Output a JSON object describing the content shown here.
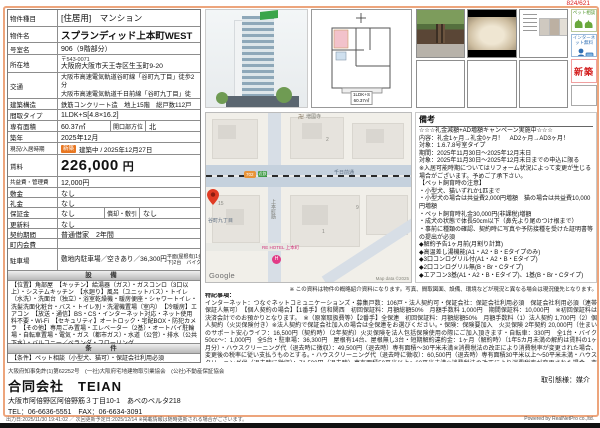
{
  "header": {
    "ref": "824/621"
  },
  "table": {
    "r_type": {
      "label": "物件種目",
      "value": "[住居用]　マンション"
    },
    "r_name": {
      "label": "物件名",
      "value": "スプランディッド上本町WEST"
    },
    "r_room": {
      "label": "号室名",
      "value": "906（9階部分）"
    },
    "r_addr": {
      "label": "所在地",
      "postal": "〒543-0071",
      "value": "大阪府大阪市天王寺区生玉町9-20"
    },
    "r_access": {
      "label": "交通",
      "lines": "大阪市高速電気軌道谷町線「谷町九丁目」徒歩2分\n大阪市高速電気軌道千日前線「谷町九丁目」徒歩2分\n近鉄難波・奈良線「大阪上本町」徒歩8分"
    },
    "r_structure": {
      "label": "建築構造",
      "value": "鉄筋コンクリート造　地上15階　総戸数112戸"
    },
    "r_layout": {
      "label": "間取タイプ",
      "value": "1LDK+S[4.8×16.2]"
    },
    "r_area": {
      "label": "専有面積",
      "value": "60.37㎡",
      "label2": "開口部方位",
      "value2": "北"
    },
    "r_built": {
      "label": "築年",
      "value": "2025年12月"
    },
    "r_status": {
      "label": "現況/入居時期",
      "badge": "新築",
      "value": "建築中 / 2025年12月27日"
    },
    "r_rent": {
      "label": "賃料",
      "value": "226,000",
      "unit": "円"
    },
    "r_fee": {
      "label": "共益費・管理費",
      "value": "12,000円"
    },
    "r_shikikin": {
      "label": "敷金",
      "value": "なし"
    },
    "r_reikin": {
      "label": "礼金",
      "value": "なし"
    },
    "r_hoshokin": {
      "label": "保証金",
      "value": "なし",
      "label2": "償却・敷引",
      "value2": "なし"
    },
    "r_koshin": {
      "label": "更新料",
      "value": "なし"
    },
    "r_keiyaku": {
      "label": "契約期間",
      "value": "普通借家　2年間"
    },
    "r_chonai": {
      "label": "町内会費",
      "value": ""
    },
    "r_parking": {
      "label": "駐車場",
      "value": "敷地内駐車場／空きあり／36,300円",
      "detail": "平面(屋根有)1台 平面(屋根無)2台 機械式(地上)1台 機械式(地下)2台　バイク(屋根有)9台 ミニバイク(屋根有)9台"
    }
  },
  "facilities": {
    "header": "設　備",
    "text": "【位置】角部屋　【キッチン】給湯器（ガス）・ガスコンロ（3口以上）・システムキッチン　【水廻り】風呂（ユニットバス）・トイレ（水洗）・洗面台（独立）・浴室乾燥機・暖房便座・シャワートイレ・洗髪洗面化粧台・バス・トイレ別・洗濯機置場（室内）　【冷暖房】エアコン　【放送・通信】BS・CS・インターネット対応・ネット使用料不要・Wi-Fi　【セキュリティ】オートロック・宅配BOX・防犯カメラ　【その他】専用ごみ置場・エレベーター（2基）・オートバイ駐輪場・自転車置場・電気・ガス（都市ガス）・水道（公営）・排水（公共下水）・バルコニー／ベランダ・フローリング"
  },
  "conditions": {
    "header": "条　件",
    "text": "【条件】ペット相談（小型犬、猫可）・保証会社利用必須"
  },
  "remarks": {
    "header": "備考",
    "text": "☆☆☆礼金減額+AD増額キャンペーン実施中☆☆☆\n内容：礼金1ヶ月→礼金0ヶ月！　AD2ヶ月→AD3ヶ月！\n対象：1.6.7.8号室タイプ\n期間：2025年11月30日～2025年12月末日\n対象：2025年11月30日～2025年12月末日までの申込に限る\n※入居可能時期についてはリフォーム状況によって変更が生じる場合がございます。予めご了承下さい。\n【ペット飼育時の注意】\n・小型犬、猫いずれか1匹まで\n・小型犬の場合は共益費2,000円増額　猫の場合は共益費10,000円増額\n・ペット飼育時礼金30,000円(非課税)増額\n・成犬の状態で体長50cm以下（鼻先より尾のつけ根まで）\n・事前に種類の確認、契約時に写真や予防接種を受けた証明書等の提出が必須\n◆解約予告1ヶ月前(月割り計算)\n◆高温差し湯機能(A1・A2・B・Eタイプのみ)\n◆3口コンログリル付(A1・A2・B・Eタイプ)\n◆2口コンログリル無(B・Br・Cタイプ)\n◆エアコン3基(A1・A2・B・Eタイプ)、1基(B・Br・Cタイプ)"
  },
  "notes": {
    "disclaimer": "※ この資料は物件の概略紹介資料になります。写真、間取図面、設備、環境などが現況と異なる場合は現況優先となります。",
    "title": "特記事項：",
    "text": "インターネット：つなぐネットコミュニケーションズ・募集戸数：106戸・法人契約可・保証会社：保証会社利用必須　保証会社利用必須（連帯保証人無可）　【個人契約の場合】【1番手】信和関西　初回保証料：月額総額50%　月額手数料 1,000円　期間保証料：10,000円　※初回保証料は決済会計でのお預かりとなります。　※（原案取扱費等）【2番手】全保連　初回保証料：月額総額50%　月額手数料（1）法人契約 1,700円（2）個人契約（火災保険付き）※法人契約で保証会社加入の場合は全保連をお選びください。・保険：保険要加入　火災保険 2年契約 20,000円（住まいのサポート安心ライフ：16,500円（契約時）（2年契約）火災保険を法人包括保険使用の際にご加入頂きます・自転車：330円　全1台・バイク50cc～：1,000円　全5台・駐車場：36,300円　屋根有14台、屋根無し3台・短期解約違約金：1ヶ月（解約時）（1年5カ月未満の解約は賃料の1ヶ月分）・ハウスクリーニング代（退去時に徴収）：49,500円（退去時）専有面積～30平米未満※消費税法の改正により消費税率が変更された場合、変更後の税率に従い支払うものとする。・ハウスクリーニング代（退去時に徴収）：60,500円（退去時）専有面積30平米以上～50平米未満・ハウスクリーニング代（退去時に徴収）：71,500円（退去時）専有面積50平米以上～60平米未満※消費税法の改正により消費税率が変更された場合、変更後の税率に従い支払うものとする。・ハウスクリーニング代（退去時に徴収）：82,500円（退去時）専有面積60平米以上～70平米未満・ハウスクリーニング代（退去時に徴収）：93,500円（退去時）専有面積70平米以上～80平米未満※消費税法の改正により消費税率が変更された場合、変更後の税率に従い支払うものとする。"
  },
  "badges": {
    "pet": "ペット相談",
    "internet": "インターネット無料",
    "new": "新築"
  },
  "photos": {
    "floorplan_caption1": "1LDK+S",
    "floorplan_caption2": "60.37㎡"
  },
  "map": {
    "temple": "増國寺",
    "temple_mark": "卍",
    "road_h": "千日前通",
    "street_v": "上本町筋",
    "shield": "702",
    "gflag": "近鉄",
    "station": "谷町九丁目",
    "hotel": "RE HOTEL 上本町",
    "num1": "2",
    "num2": "9",
    "num3": "1",
    "num4": "15",
    "google": "Google",
    "copyright": "Map data ©2025"
  },
  "company": {
    "license": "大阪府知事免許(1)第62252号　(一社)大阪府宅地建物取引業協会　(公社)不動産保証協会",
    "name": "合同会社　TEIAN",
    "address": "大阪市阿倍野区阿倍野筋３丁目10-1　あべのベルタ218",
    "tel": "TEL：06-6636-5551　FAX：06-6634-3091",
    "deal_type": "取引態様：媒介"
  },
  "footer": {
    "left": "出力日:2025/11/30 19:41:02 ／ 次回更新予定日:2025/12/14 ※掲載情報は随時更新される場合がございます。",
    "right": "Powered by RealNetPro co.,ltd."
  },
  "colors": {
    "frame": "#eda57c",
    "accent_red": "#d41e1e",
    "badge_orange": "#e87722",
    "pet_green": "#4d9427",
    "net_blue": "#2f6fb4"
  }
}
